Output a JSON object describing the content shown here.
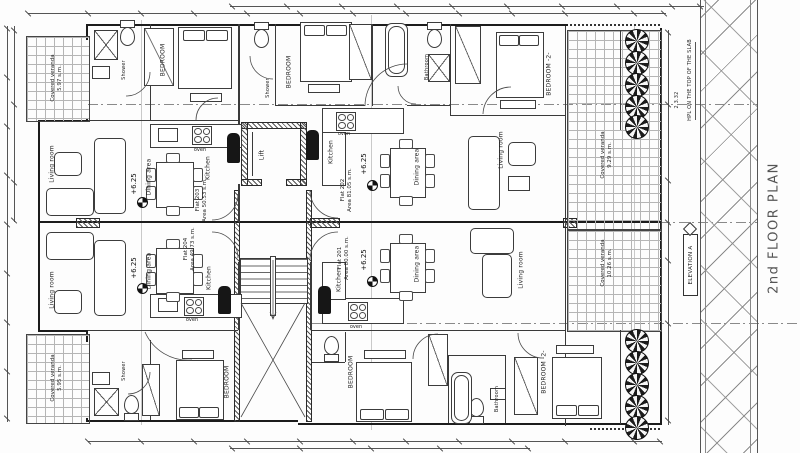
{
  "drawing": {
    "title": "2nd FLOOR PLAN",
    "elevation_marker": "ELEVATION A",
    "slab_note": "HPL ON THE TOP OF THE SLAB",
    "slab_note_dim": "2 3.32",
    "level": "+6.25"
  },
  "flats": {
    "f203": {
      "name": "Flat 203",
      "area": "Area 50.53 s.m."
    },
    "f204": {
      "name": "Flat 204",
      "area": "Area 49.73 s.m."
    },
    "f202": {
      "name": "Flat 202",
      "area": "Area 81.05 s.m."
    },
    "f201": {
      "name": "Flat 201",
      "area": "Area 80.00 s.m."
    }
  },
  "rooms": {
    "bedroom": "BEDROOM",
    "bedroom2": "BEDROOM -2-",
    "living": "Living room",
    "dining": "Dining area",
    "kitchen": "Kitchen",
    "bathroom": "Bathroom",
    "shower": "Shower",
    "lift": "Lift",
    "oven": "oven"
  },
  "verandas": {
    "tl": {
      "label": "Covered veranda",
      "area": "5.97 s.m."
    },
    "bl": {
      "label": "Covered veranda",
      "area": "5.95 s.m."
    },
    "tr": {
      "label": "Covered veranda",
      "area": "9.29 s.m."
    },
    "br": {
      "label": "Covered veranda",
      "area": "10.26 s.m."
    }
  }
}
